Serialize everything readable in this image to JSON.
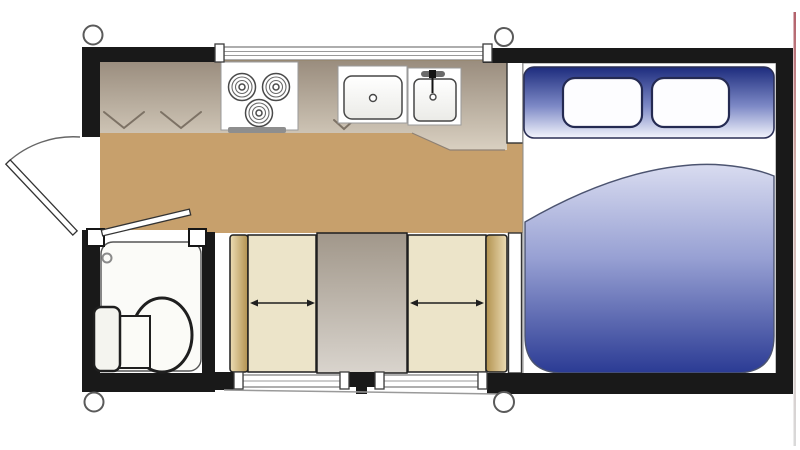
{
  "content": {
    "type": "truck-camper-floorplan",
    "rooms": {
      "kitchen": {
        "fixtures": [
          "cabinet-counter",
          "cooktop-3-burner",
          "kitchen-sink",
          "bar-sink-with-faucet"
        ]
      },
      "bathroom": {
        "fixtures": [
          "shower-pan",
          "shower-drain",
          "toilet",
          "bathroom-door"
        ]
      },
      "dinette": {
        "fixtures": [
          "bench-seat-left",
          "dinette-table",
          "bench-seat-right"
        ]
      },
      "bedroom": {
        "fixtures": [
          "mattress",
          "comforter",
          "headboard-shelf",
          "pillow-left",
          "pillow-right"
        ]
      }
    },
    "openings": [
      "entry-door",
      "front-window",
      "rear-window-left",
      "rear-window-right"
    ],
    "counts": {
      "burners": 3,
      "pillows": 2,
      "windows": 3,
      "corner_jacks": 4,
      "dinette_seats": 2,
      "cabinet_swing_marks": 3
    }
  },
  "colors": {
    "paper": "#ffffff",
    "wall": "#191919",
    "outline": "#1f1f1f",
    "floor": "#c7a06c",
    "counterDark": "#9a8d7e",
    "counterLight": "#d9d0c1",
    "vmark": "#7d7265",
    "cushion": "#ece4c9",
    "seatbackLight": "#ecdcb4",
    "seatbackDark": "#b2924f",
    "tableDark": "#a1978a",
    "tableLight": "#d9d4cd",
    "headboardTop": "#1d2c7d",
    "headboardMid": "#7d89c6",
    "headboardBottom": "#f3f5fc",
    "comforterTop": "#d9dcf0",
    "comforterMid": "#97a0d3",
    "comforterBottom": "#2b3b94",
    "artifactTop": "#a03a46",
    "artifactMid": "#c59a94",
    "artifactBottom": "#d0d0d0"
  }
}
